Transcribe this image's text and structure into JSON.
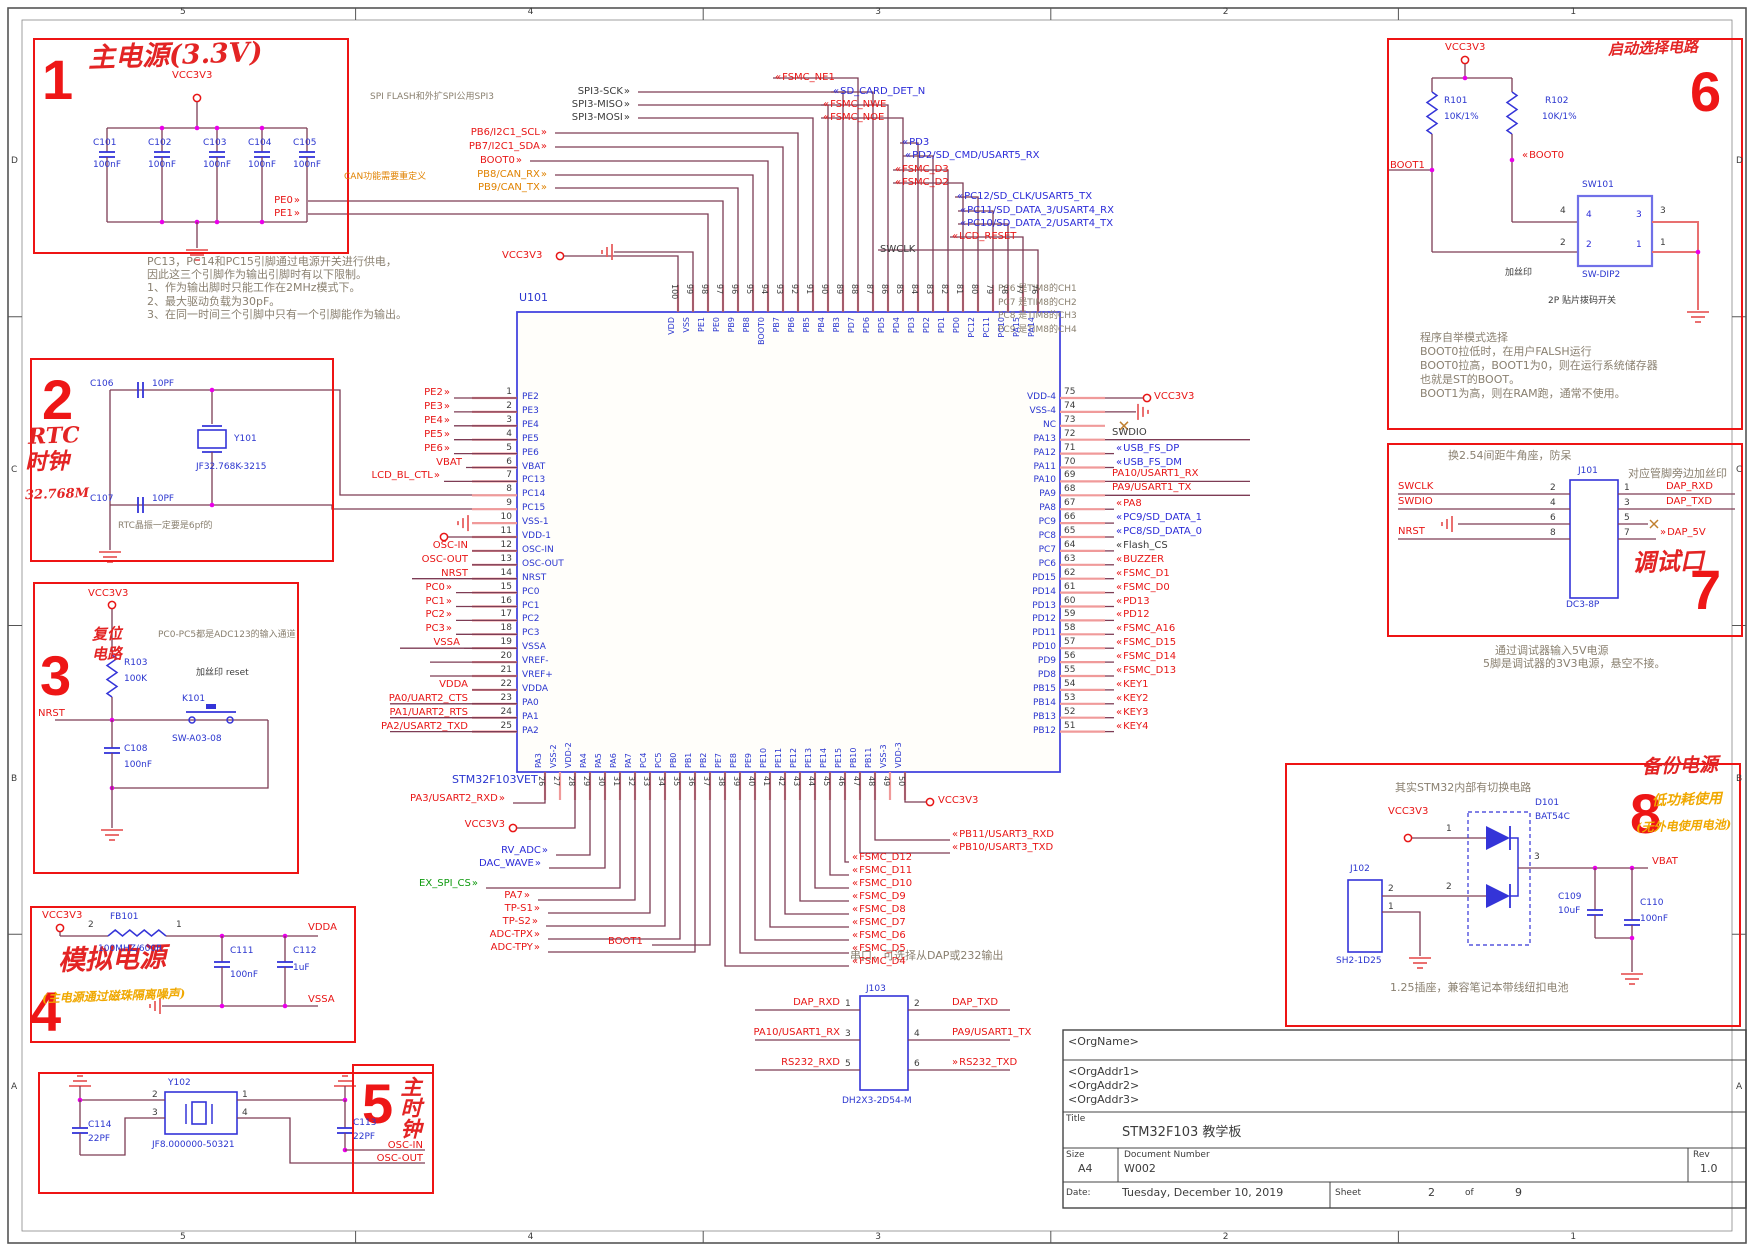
{
  "frame": {
    "top_ticks": [
      "5",
      "4",
      "3",
      "2",
      "1"
    ],
    "side_ticks": [
      "D",
      "C",
      "B",
      "A"
    ]
  },
  "boxes": {
    "b1": {
      "num": "1",
      "title": "主电源(3.3V)",
      "net": "VCC3V3",
      "caps": [
        {
          "ref": "C101",
          "val": "100nF"
        },
        {
          "ref": "C102",
          "val": "100nF"
        },
        {
          "ref": "C103",
          "val": "100nF"
        },
        {
          "ref": "C104",
          "val": "100nF"
        },
        {
          "ref": "C105",
          "val": "100nF"
        }
      ]
    },
    "b1_note": [
      "PC13，PC14和PC15引脚通过电源开关进行供电，",
      "因此这三个引脚作为输出引脚时有以下限制。",
      "1、作为输出脚时只能工作在2MHz模式下。",
      "2、最大驱动负载为30pF。",
      "3、在同一时间三个引脚中只有一个引脚能作为输出。"
    ],
    "b2": {
      "num": "2",
      "hand1": "RTC",
      "hand2": "时钟",
      "hand3": "32.768M",
      "ctop": {
        "ref": "C106",
        "val": "10PF"
      },
      "cbot": {
        "ref": "C107",
        "val": "10PF"
      },
      "xtal": {
        "ref": "Y101",
        "part": "JF32.768K-3215"
      },
      "note": "RTC晶振一定要是6pf的"
    },
    "b3": {
      "num": "3",
      "hand1": "复位",
      "hand2": "电路",
      "net": "VCC3V3",
      "res": {
        "ref": "R103",
        "val": "100K"
      },
      "sw": {
        "ref": "K101",
        "part": "SW-A03-08"
      },
      "cap": {
        "ref": "C108",
        "val": "100nF"
      },
      "nrst": "NRST",
      "note_adc": "PC0-PC5都是ADC123的输入通道",
      "note_silk": "加丝印 reset"
    },
    "b4": {
      "num": "4",
      "hand": "模拟电源",
      "hand2": "(主电源通过磁珠隔离噪声)",
      "net": "VCC3V3",
      "fb": {
        "ref": "FB101",
        "val": "100MHZ/600R"
      },
      "p2": "2",
      "p1": "1",
      "c1": {
        "ref": "C111",
        "val": "100nF"
      },
      "c2": {
        "ref": "C112",
        "val": "1uF"
      },
      "vdda": "VDDA",
      "vssa": "VSSA"
    },
    "b5": {
      "num": "5",
      "hand": "主时钟",
      "xtal": {
        "ref": "Y102",
        "part": "JF8.000000-50321"
      },
      "p2": "2",
      "p3": "3",
      "p1": "1",
      "p4": "4",
      "cl": {
        "ref": "C114",
        "val": "22PF"
      },
      "cr": {
        "ref": "C113",
        "val": "22PF"
      },
      "oscin": "OSC-IN",
      "oscout": "OSC-OUT"
    },
    "b6": {
      "num": "6",
      "hand": "启动选择电路",
      "net": "VCC3V3",
      "r1": {
        "ref": "R101",
        "val": "10K/1%"
      },
      "r2": {
        "ref": "R102",
        "val": "10K/1%"
      },
      "boot1": "BOOT1",
      "boot0": "BOOT0",
      "sw": {
        "ref": "SW101",
        "part": "SW-DIP2"
      },
      "sp": [
        "4",
        "2",
        "3",
        "1"
      ],
      "silk": "加丝印",
      "desc": "2P 贴片拨码开关",
      "note": [
        "程序自举模式选择",
        "BOOT0拉低时，在用户FALSH运行",
        "BOOT0拉高，BOOT1为0，则在运行系统储存器",
        "也就是ST的BOOT。",
        "BOOT1为高，则在RAM跑，通常不使用。"
      ]
    },
    "b7": {
      "num": "7",
      "hand": "调试口",
      "note_top": "换2.54间距牛角座，防呆",
      "silk": "对应管脚旁边加丝印",
      "conn": {
        "ref": "J101",
        "part": "DC3-8P"
      },
      "lnets": [
        "SWCLK",
        "SWDIO",
        "",
        "NRST"
      ],
      "lnums": [
        "2",
        "4",
        "6",
        "8"
      ],
      "rnums": [
        "1",
        "3",
        "5",
        "7"
      ],
      "rnets": [
        "DAP_RXD",
        "DAP_TXD",
        "",
        "DAP_5V"
      ],
      "note_below": [
        "通过调试器输入5V电源",
        "5脚是调试器的3V3电源，悬空不接。"
      ]
    },
    "b8": {
      "num": "8",
      "hand": "备份电源",
      "hand2": "低功耗使用",
      "hand3": "(无外电使用电池)",
      "note": "其实STM32内部有切换电路",
      "net": "VCC3V3",
      "d": {
        "ref": "D101",
        "part": "BAT54C"
      },
      "conn": {
        "ref": "J102",
        "part": "SH2-1D25"
      },
      "vbat": "VBAT",
      "c1": {
        "ref": "C109",
        "val": "10uF"
      },
      "c2": {
        "ref": "C110",
        "val": "100nF"
      },
      "pin_in1": "1",
      "pin_in2": "2",
      "pin_out": "3",
      "pin_j2": "2",
      "pin_j1": "1",
      "note_bottom": "1.25插座，兼容笔记本带线纽扣电池"
    }
  },
  "mcu": {
    "ref": "U101",
    "part": "STM32F103VET",
    "top_vcc": "VCC3V3",
    "notes": {
      "spi": "SPI FLASH和外扩SPI公用SPI3",
      "can": "CAN功能需要重定义",
      "serial": "串口，可选择从DAP或232输出",
      "tim8": [
        "PC6 是TIM8的CH1",
        "PC7 是TIM8的CH2",
        "PC8 是TIM8的CH3",
        "PC9 是TIM8的CH4"
      ]
    },
    "left_pins": [
      {
        "n": "1",
        "name": "PE2",
        "lbl": "PE2",
        "c": "r"
      },
      {
        "n": "2",
        "name": "PE3",
        "lbl": "PE3",
        "c": "r"
      },
      {
        "n": "3",
        "name": "PE4",
        "lbl": "PE4",
        "c": "r"
      },
      {
        "n": "4",
        "name": "PE5",
        "lbl": "PE5",
        "c": "r"
      },
      {
        "n": "5",
        "name": "PE6",
        "lbl": "PE6",
        "c": "r"
      },
      {
        "n": "6",
        "name": "VBAT",
        "lbl": "VBAT",
        "c": "r"
      },
      {
        "n": "7",
        "name": "PC13",
        "lbl": "LCD_BL_CTL",
        "c": "r"
      },
      {
        "n": "8",
        "name": "PC14",
        "lbl": "",
        "c": ""
      },
      {
        "n": "9",
        "name": "PC15",
        "lbl": "",
        "c": ""
      },
      {
        "n": "10",
        "name": "VSS-1",
        "lbl": "",
        "c": ""
      },
      {
        "n": "11",
        "name": "VDD-1",
        "lbl": "VCC3V3",
        "c": "r"
      },
      {
        "n": "12",
        "name": "OSC-IN",
        "lbl": "OSC-IN",
        "c": "r"
      },
      {
        "n": "13",
        "name": "OSC-OUT",
        "lbl": "OSC-OUT",
        "c": "r"
      },
      {
        "n": "14",
        "name": "NRST",
        "lbl": "NRST",
        "c": "r"
      },
      {
        "n": "15",
        "name": "PC0",
        "lbl": "PC0",
        "c": "r"
      },
      {
        "n": "16",
        "name": "PC1",
        "lbl": "PC1",
        "c": "r"
      },
      {
        "n": "17",
        "name": "PC2",
        "lbl": "PC2",
        "c": "r"
      },
      {
        "n": "18",
        "name": "PC3",
        "lbl": "PC3",
        "c": "r"
      },
      {
        "n": "19",
        "name": "VSSA",
        "lbl": "VSSA",
        "c": "r"
      },
      {
        "n": "20",
        "name": "VREF-",
        "lbl": "",
        "c": ""
      },
      {
        "n": "21",
        "name": "VREF+",
        "lbl": "",
        "c": ""
      },
      {
        "n": "22",
        "name": "VDDA",
        "lbl": "VDDA",
        "c": "r"
      },
      {
        "n": "23",
        "name": "PA0",
        "lbl": "PA0/UART2_CTS",
        "c": "r"
      },
      {
        "n": "24",
        "name": "PA1",
        "lbl": "PA1/UART2_RTS",
        "c": "r"
      },
      {
        "n": "25",
        "name": "PA2",
        "lbl": "PA2/USART2_TXD",
        "c": "r"
      }
    ],
    "right_pins": [
      {
        "n": "75",
        "name": "VDD-4",
        "lbl": "VCC3V3",
        "c": "r"
      },
      {
        "n": "74",
        "name": "VSS-4",
        "lbl": "",
        "c": ""
      },
      {
        "n": "73",
        "name": "NC",
        "lbl": "",
        "c": ""
      },
      {
        "n": "72",
        "name": "PA13",
        "lbl": "SWDIO",
        "c": "k"
      },
      {
        "n": "71",
        "name": "PA12",
        "lbl": "USB_FS_DP",
        "c": "b"
      },
      {
        "n": "70",
        "name": "PA11",
        "lbl": "USB_FS_DM",
        "c": "b"
      },
      {
        "n": "69",
        "name": "PA10",
        "lbl": "PA10/USART1_RX",
        "c": "r"
      },
      {
        "n": "68",
        "name": "PA9",
        "lbl": "PA9/USART1_TX",
        "c": "r"
      },
      {
        "n": "67",
        "name": "PA8",
        "lbl": "PA8",
        "c": "r"
      },
      {
        "n": "66",
        "name": "PC9",
        "lbl": "PC9/SD_DATA_1",
        "c": "b"
      },
      {
        "n": "65",
        "name": "PC8",
        "lbl": "PC8/SD_DATA_0",
        "c": "b"
      },
      {
        "n": "64",
        "name": "PC7",
        "lbl": "Flash_CS",
        "c": "k"
      },
      {
        "n": "63",
        "name": "PC6",
        "lbl": "BUZZER",
        "c": "r"
      },
      {
        "n": "62",
        "name": "PD15",
        "lbl": "FSMC_D1",
        "c": "r"
      },
      {
        "n": "61",
        "name": "PD14",
        "lbl": "FSMC_D0",
        "c": "r"
      },
      {
        "n": "60",
        "name": "PD13",
        "lbl": "PD13",
        "c": "r"
      },
      {
        "n": "59",
        "name": "PD12",
        "lbl": "PD12",
        "c": "r"
      },
      {
        "n": "58",
        "name": "PD11",
        "lbl": "FSMC_A16",
        "c": "r"
      },
      {
        "n": "57",
        "name": "PD10",
        "lbl": "FSMC_D15",
        "c": "r"
      },
      {
        "n": "56",
        "name": "PD9",
        "lbl": "FSMC_D14",
        "c": "r"
      },
      {
        "n": "55",
        "name": "PD8",
        "lbl": "FSMC_D13",
        "c": "r"
      },
      {
        "n": "54",
        "name": "PB15",
        "lbl": "KEY1",
        "c": "r"
      },
      {
        "n": "53",
        "name": "PB14",
        "lbl": "KEY2",
        "c": "r"
      },
      {
        "n": "52",
        "name": "PB13",
        "lbl": "KEY3",
        "c": "r"
      },
      {
        "n": "51",
        "name": "PB12",
        "lbl": "KEY4",
        "c": "r"
      }
    ],
    "top_pins": [
      {
        "n": "100",
        "name": "VDD"
      },
      {
        "n": "99",
        "name": "VSS"
      },
      {
        "n": "98",
        "name": "PE1"
      },
      {
        "n": "97",
        "name": "PE0"
      },
      {
        "n": "96",
        "name": "PB9"
      },
      {
        "n": "95",
        "name": "PB8"
      },
      {
        "n": "94",
        "name": "BOOT0"
      },
      {
        "n": "93",
        "name": "PB7"
      },
      {
        "n": "92",
        "name": "PB6"
      },
      {
        "n": "91",
        "name": "PB5"
      },
      {
        "n": "90",
        "name": "PB4"
      },
      {
        "n": "89",
        "name": "PB3"
      },
      {
        "n": "88",
        "name": "PD7"
      },
      {
        "n": "87",
        "name": "PD6"
      },
      {
        "n": "86",
        "name": "PD5"
      },
      {
        "n": "85",
        "name": "PD4"
      },
      {
        "n": "84",
        "name": "PD3"
      },
      {
        "n": "83",
        "name": "PD2"
      },
      {
        "n": "82",
        "name": "PD1"
      },
      {
        "n": "81",
        "name": "PD0"
      },
      {
        "n": "80",
        "name": "PC12"
      },
      {
        "n": "79",
        "name": "PC11"
      },
      {
        "n": "78",
        "name": "PC10"
      },
      {
        "n": "77",
        "name": "PA15"
      },
      {
        "n": "76",
        "name": "PA14"
      }
    ],
    "bottom_pins": [
      {
        "n": "26",
        "name": "PA3"
      },
      {
        "n": "27",
        "name": "VSS-2"
      },
      {
        "n": "28",
        "name": "VDD-2"
      },
      {
        "n": "29",
        "name": "PA4"
      },
      {
        "n": "30",
        "name": "PA5"
      },
      {
        "n": "31",
        "name": "PA6"
      },
      {
        "n": "32",
        "name": "PA7"
      },
      {
        "n": "33",
        "name": "PC4"
      },
      {
        "n": "34",
        "name": "PC5"
      },
      {
        "n": "35",
        "name": "PB0"
      },
      {
        "n": "36",
        "name": "PB1"
      },
      {
        "n": "37",
        "name": "PB2"
      },
      {
        "n": "38",
        "name": "PE7"
      },
      {
        "n": "39",
        "name": "PE8"
      },
      {
        "n": "40",
        "name": "PE9"
      },
      {
        "n": "41",
        "name": "PE10"
      },
      {
        "n": "42",
        "name": "PE11"
      },
      {
        "n": "43",
        "name": "PE12"
      },
      {
        "n": "44",
        "name": "PE13"
      },
      {
        "n": "45",
        "name": "PE14"
      },
      {
        "n": "46",
        "name": "PE15"
      },
      {
        "n": "47",
        "name": "PB10"
      },
      {
        "n": "48",
        "name": "PB11"
      },
      {
        "n": "49",
        "name": "VSS-3"
      },
      {
        "n": "50",
        "name": "VDD-3"
      }
    ],
    "top_left_labels": [
      {
        "t": "SPI3-SCK",
        "c": "k",
        "pin": 89
      },
      {
        "t": "SPI3-MISO",
        "c": "k",
        "pin": 90
      },
      {
        "t": "SPI3-MOSI",
        "c": "k",
        "pin": 91
      },
      {
        "t": "PB6/I2C1_SCL",
        "c": "r",
        "pin": 92
      },
      {
        "t": "PB7/I2C1_SDA",
        "c": "r",
        "pin": 93
      },
      {
        "t": "BOOT0",
        "c": "r",
        "pin": 94
      },
      {
        "t": "PB8/CAN_RX",
        "c": "o",
        "pin": 95
      },
      {
        "t": "PB9/CAN_TX",
        "c": "o",
        "pin": 96
      },
      {
        "t": "PE0",
        "c": "r",
        "pin": 97
      },
      {
        "t": "PE1",
        "c": "r",
        "pin": 98
      }
    ],
    "top_right_labels": [
      {
        "t": "FSMC_NE1",
        "c": "r",
        "pin": 88
      },
      {
        "t": "SD_CARD_DET_N",
        "c": "b",
        "pin": 87
      },
      {
        "t": "FSMC_NWE",
        "c": "r",
        "pin": 86
      },
      {
        "t": "FSMC_NOE",
        "c": "r",
        "pin": 85
      },
      {
        "t": "PD3",
        "c": "b",
        "pin": 84
      },
      {
        "t": "PD2/SD_CMD/USART5_RX",
        "c": "b",
        "pin": 83
      },
      {
        "t": "FSMC_D3",
        "c": "r",
        "pin": 82
      },
      {
        "t": "FSMC_D2",
        "c": "r",
        "pin": 81
      },
      {
        "t": "PC12/SD_CLK/USART5_TX",
        "c": "b",
        "pin": 80
      },
      {
        "t": "PC11/SD_DATA_3/USART4_RX",
        "c": "b",
        "pin": 79
      },
      {
        "t": "PC10/SD_DATA_2/USART4_TX",
        "c": "b",
        "pin": 78
      },
      {
        "t": "LCD_RESET",
        "c": "r",
        "pin": 77
      },
      {
        "t": "SWCLK",
        "c": "k",
        "pin": 76
      }
    ],
    "bottom_left_labels": [
      {
        "t": "PA3/USART2_RXD",
        "c": "r",
        "pin": 26
      },
      {
        "t": "VCC3V3",
        "c": "r",
        "pin": 28
      },
      {
        "t": "RV_ADC",
        "c": "b",
        "pin": 29
      },
      {
        "t": "DAC_WAVE",
        "c": "b",
        "pin": 30
      },
      {
        "t": "EX_SPI_CS",
        "c": "g",
        "pin": 31
      },
      {
        "t": "PA7",
        "c": "r",
        "pin": 32
      },
      {
        "t": "TP-S1",
        "c": "r",
        "pin": 33
      },
      {
        "t": "TP-S2",
        "c": "r",
        "pin": 34
      },
      {
        "t": "ADC-TPX",
        "c": "r",
        "pin": 35
      },
      {
        "t": "ADC-TPY",
        "c": "r",
        "pin": 36
      },
      {
        "t": "BOOT1",
        "c": "r",
        "pin": 37
      }
    ],
    "bottom_right_labels": [
      {
        "t": "VCC3V3",
        "c": "r",
        "pin": 50
      },
      {
        "t": "PB11/USART3_RXD",
        "c": "r",
        "pin": 48
      },
      {
        "t": "PB10/USART3_TXD",
        "c": "r",
        "pin": 47
      },
      {
        "t": "FSMC_D12",
        "c": "r",
        "pin": 46
      },
      {
        "t": "FSMC_D11",
        "c": "r",
        "pin": 45
      },
      {
        "t": "FSMC_D10",
        "c": "r",
        "pin": 44
      },
      {
        "t": "FSMC_D9",
        "c": "r",
        "pin": 43
      },
      {
        "t": "FSMC_D8",
        "c": "r",
        "pin": 42
      },
      {
        "t": "FSMC_D7",
        "c": "r",
        "pin": 41
      },
      {
        "t": "FSMC_D6",
        "c": "r",
        "pin": 40
      },
      {
        "t": "FSMC_D5",
        "c": "r",
        "pin": 39
      },
      {
        "t": "FSMC_D4",
        "c": "r",
        "pin": 38
      }
    ]
  },
  "j103": {
    "ref": "J103",
    "part": "DH2X3-2D54-M",
    "lnets": [
      "DAP_RXD",
      "PA10/USART1_RX",
      "RS232_RXD"
    ],
    "lnums": [
      "1",
      "3",
      "5"
    ],
    "rnums": [
      "2",
      "4",
      "6"
    ],
    "rnets": [
      "DAP_TXD",
      "PA9/USART1_TX",
      "RS232_TXD"
    ]
  },
  "titleblock": {
    "org": "<OrgName>",
    "addr1": "<OrgAddr1>",
    "addr2": "<OrgAddr2>",
    "addr3": "<OrgAddr3>",
    "title_label": "Title",
    "title": "STM32F103 教学板",
    "size_label": "Size",
    "size": "A4",
    "doc_label": "Document Number",
    "doc": "W002",
    "rev_label": "Rev",
    "rev": "1.0",
    "date_label": "Date:",
    "date": "Tuesday, December 10, 2019",
    "sheet_label": "Sheet",
    "sheet": "2",
    "of": "of",
    "total": "9"
  }
}
